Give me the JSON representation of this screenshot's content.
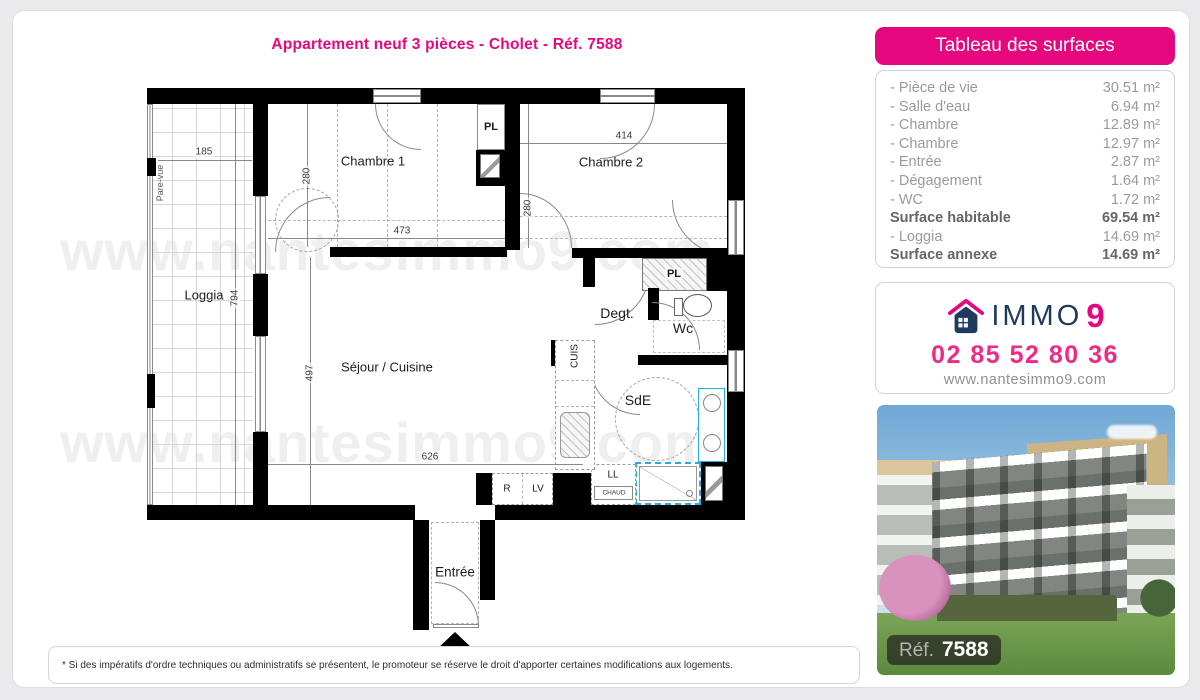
{
  "page": {
    "title": "Appartement neuf 3 pièces - Cholet - Réf. 7588",
    "disclaimer": "* Si des impératifs d'ordre techniques ou administratifs se présentent, le promoteur se réserve le droit d'apporter certaines modifications aux logements."
  },
  "colors": {
    "accent_pink": "#e6077e",
    "brand_navy": "#1e3a5c",
    "fixture_blue": "#29abe2",
    "wall_black": "#000000"
  },
  "surface_table": {
    "header": "Tableau des surfaces",
    "rows": [
      {
        "label": "- Pièce de vie",
        "value": "30.51 m²",
        "bold": false
      },
      {
        "label": "- Salle d'eau",
        "value": "6.94 m²",
        "bold": false
      },
      {
        "label": "- Chambre",
        "value": "12.89 m²",
        "bold": false
      },
      {
        "label": "- Chambre",
        "value": "12.97 m²",
        "bold": false
      },
      {
        "label": "- Entrée",
        "value": "2.87 m²",
        "bold": false
      },
      {
        "label": "- Dégagement",
        "value": "1.64 m²",
        "bold": false
      },
      {
        "label": "- WC",
        "value": "1.72 m²",
        "bold": false
      },
      {
        "label": "Surface habitable",
        "value": "69.54 m²",
        "bold": true
      },
      {
        "label": "- Loggia",
        "value": "14.69 m²",
        "bold": false
      },
      {
        "label": "Surface annexe",
        "value": "14.69 m²",
        "bold": true
      }
    ]
  },
  "agency": {
    "brand": "IMMO",
    "brand_number": "9",
    "phone": "02 85 52 80 36",
    "website": "www.nantesimmo9.com"
  },
  "photo": {
    "ref_label": "Réf.",
    "ref_value": "7588"
  },
  "floorplan": {
    "watermark": "www.nantesimmo9.com",
    "labels": {
      "chambre1": "Chambre 1",
      "chambre2": "Chambre 2",
      "loggia": "Loggia",
      "sejour": "Séjour / Cuisine",
      "entree": "Entrée",
      "degagement": "Degt.",
      "wc": "Wc",
      "salle_eau": "SdE",
      "placard_top": "PL",
      "placard_right": "PL",
      "cuisine": "CUIS",
      "lave_linge": "LL",
      "chaudiere": "CHAUD",
      "refrigerateur": "R",
      "lave_vaisselle": "LV",
      "pare_vue": "Pare-vue"
    },
    "dimensions": {
      "loggia_width": "185",
      "loggia_height": "794",
      "chambre1_width": "473",
      "chambre1_height": "280",
      "chambre2_width": "414",
      "chambre2_height": "280",
      "sejour_width": "626",
      "sejour_height": "497"
    }
  }
}
